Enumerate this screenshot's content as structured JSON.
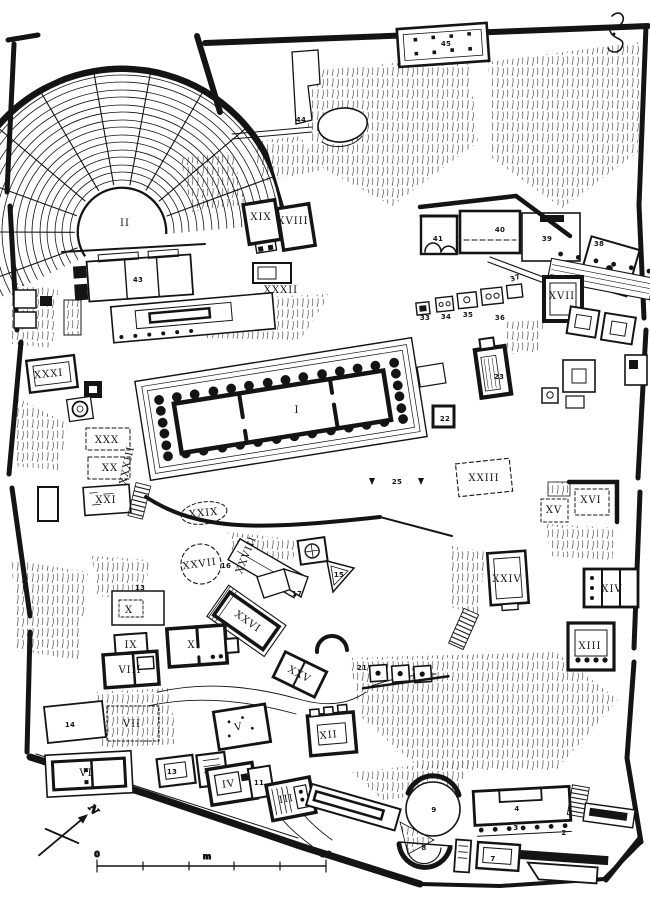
{
  "map": {
    "ink_color": "#141414",
    "paper_color": "#ffffff",
    "roman_labels": [
      {
        "t": "II",
        "x": 125,
        "y": 226,
        "s": 13
      },
      {
        "t": "I",
        "x": 297,
        "y": 413,
        "s": 13
      },
      {
        "t": "XIX",
        "x": 261,
        "y": 220,
        "s": 9
      },
      {
        "t": "XVIII",
        "x": 293,
        "y": 224,
        "s": 8
      },
      {
        "t": "XXXII",
        "x": 281,
        "y": 293
      },
      {
        "t": "XVII",
        "x": 562,
        "y": 299
      },
      {
        "t": "XXXI",
        "x": 49,
        "y": 377,
        "r": -6
      },
      {
        "t": "XXX",
        "x": 107,
        "y": 443,
        "s": 9
      },
      {
        "t": "XX",
        "x": 110,
        "y": 471,
        "s": 9
      },
      {
        "t": "XXI",
        "x": 106,
        "y": 503,
        "s": 9
      },
      {
        "t": "XXIX",
        "x": 204,
        "y": 516,
        "s": 8,
        "r": -6
      },
      {
        "t": "XXXIII",
        "x": 130,
        "y": 466,
        "s": 6,
        "r": -78
      },
      {
        "t": "XXIII",
        "x": 484,
        "y": 481,
        "s": 9
      },
      {
        "t": "XV",
        "x": 554,
        "y": 513,
        "s": 9
      },
      {
        "t": "XVI",
        "x": 591,
        "y": 503,
        "s": 9
      },
      {
        "t": "XXIV",
        "x": 507,
        "y": 582,
        "s": 9
      },
      {
        "t": "XIV",
        "x": 612,
        "y": 592
      },
      {
        "t": "XIII",
        "x": 590,
        "y": 649
      },
      {
        "t": "XXVII",
        "x": 200,
        "y": 567,
        "s": 9,
        "r": -8
      },
      {
        "t": "XXVIII",
        "x": 249,
        "y": 556,
        "s": 7,
        "r": -68
      },
      {
        "t": "XXVI",
        "x": 246,
        "y": 624,
        "s": 11,
        "r": 35
      },
      {
        "t": "XXV",
        "x": 298,
        "y": 677,
        "s": 9,
        "r": 28
      },
      {
        "t": "XI",
        "x": 194,
        "y": 648
      },
      {
        "t": "X",
        "x": 129,
        "y": 613,
        "s": 9
      },
      {
        "t": "IX",
        "x": 131,
        "y": 648,
        "s": 9
      },
      {
        "t": "VIII",
        "x": 130,
        "y": 673,
        "s": 9
      },
      {
        "t": "VII",
        "x": 132,
        "y": 727,
        "s": 9
      },
      {
        "t": "VI",
        "x": 86,
        "y": 776
      },
      {
        "t": "V",
        "x": 239,
        "y": 730,
        "r": -10
      },
      {
        "t": "IV",
        "x": 229,
        "y": 787,
        "r": -8
      },
      {
        "t": "III",
        "x": 287,
        "y": 802,
        "r": -10
      },
      {
        "t": "XII",
        "x": 329,
        "y": 738,
        "r": -6
      }
    ],
    "number_labels": [
      {
        "t": "45",
        "x": 446,
        "y": 46
      },
      {
        "t": "44",
        "x": 301,
        "y": 122
      },
      {
        "t": "43",
        "x": 138,
        "y": 282
      },
      {
        "t": "41",
        "x": 438,
        "y": 241
      },
      {
        "t": "40",
        "x": 500,
        "y": 232
      },
      {
        "t": "39",
        "x": 547,
        "y": 241
      },
      {
        "t": "38",
        "x": 599,
        "y": 246
      },
      {
        "t": "37",
        "x": 516,
        "y": 280,
        "r": -20
      },
      {
        "t": "36",
        "x": 500,
        "y": 320
      },
      {
        "t": "35",
        "x": 468,
        "y": 317
      },
      {
        "t": "34",
        "x": 446,
        "y": 319
      },
      {
        "t": "33",
        "x": 425,
        "y": 320
      },
      {
        "t": "23",
        "x": 499,
        "y": 379
      },
      {
        "t": "22",
        "x": 445,
        "y": 421
      },
      {
        "t": "25",
        "x": 397,
        "y": 484
      },
      {
        "t": "21",
        "x": 362,
        "y": 670
      },
      {
        "t": "16",
        "x": 226,
        "y": 568,
        "s": 6
      },
      {
        "t": "15",
        "x": 339,
        "y": 577
      },
      {
        "t": "17",
        "x": 297,
        "y": 596
      },
      {
        "t": "13",
        "x": 140,
        "y": 590
      },
      {
        "t": "13",
        "x": 172,
        "y": 774
      },
      {
        "t": "14",
        "x": 70,
        "y": 727
      },
      {
        "t": "11",
        "x": 259,
        "y": 785
      },
      {
        "t": "9",
        "x": 434,
        "y": 812
      },
      {
        "t": "8",
        "x": 424,
        "y": 850
      },
      {
        "t": "4",
        "x": 517,
        "y": 811
      },
      {
        "t": "3",
        "x": 516,
        "y": 830,
        "s": 5
      },
      {
        "t": "2",
        "x": 564,
        "y": 835,
        "s": 5
      },
      {
        "t": "7",
        "x": 493,
        "y": 861
      }
    ],
    "scale_bar": {
      "zero": "0",
      "unit": "m",
      "end": "50"
    },
    "compass": {
      "north": "N"
    }
  }
}
